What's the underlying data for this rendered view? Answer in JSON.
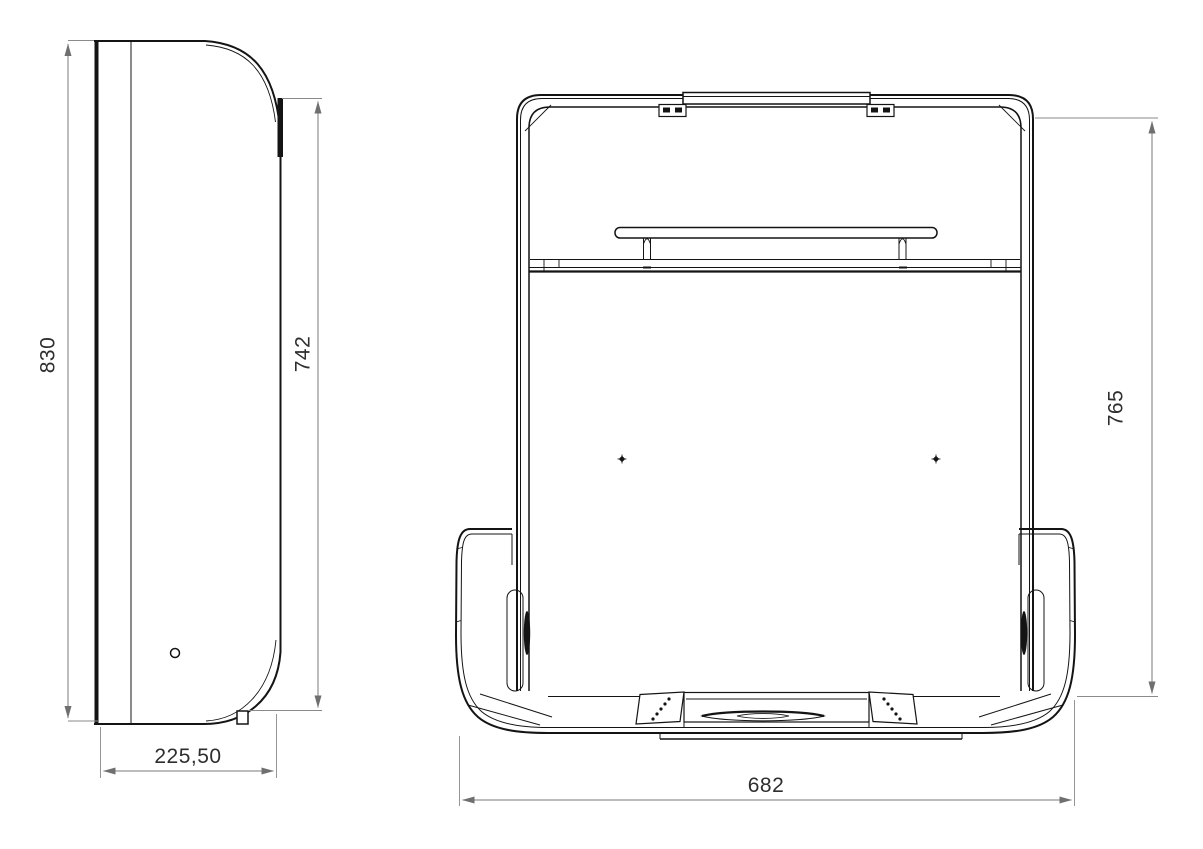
{
  "title": "folding-wall-unit-technical-drawing",
  "views": {
    "side": {
      "label": "side-view",
      "dimensions": {
        "overall_height": "830",
        "front_edge_height": "742",
        "depth": "225,50"
      }
    },
    "front": {
      "label": "front-view",
      "dimensions": {
        "overall_width": "682",
        "frame_height": "765"
      }
    }
  },
  "style": {
    "background": "#ffffff",
    "object_line_color": "#141414",
    "dimension_line_color": "#7a7a7a",
    "extension_line_color": "#8a8a8a",
    "dimension_text_color": "#2e2e2e"
  }
}
